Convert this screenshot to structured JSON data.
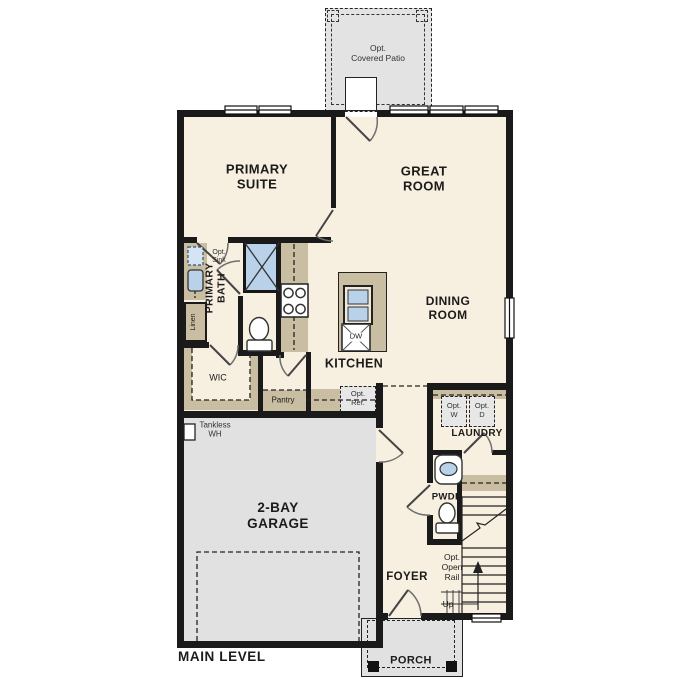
{
  "rooms": {
    "covered_patio": {
      "line1": "Opt.",
      "line2": "Covered Patio"
    },
    "primary_suite": {
      "line1": "PRIMARY",
      "line2": "SUITE"
    },
    "great_room": {
      "line1": "GREAT",
      "line2": "ROOM"
    },
    "primary_bath": {
      "line1": "PRIMARY",
      "line2": "BATH"
    },
    "wic": {
      "label": "WIC"
    },
    "linen": {
      "label": "Linen"
    },
    "kitchen": {
      "label": "KITCHEN"
    },
    "dining_room": {
      "line1": "DINING",
      "line2": "ROOM"
    },
    "pantry": {
      "label": "Pantry"
    },
    "garage": {
      "line1": "2-BAY",
      "line2": "GARAGE"
    },
    "laundry": {
      "label": "LAUNDRY"
    },
    "powder_room": {
      "label": "PWDR"
    },
    "foyer": {
      "label": "FOYER"
    },
    "porch": {
      "label": "PORCH"
    }
  },
  "fixtures": {
    "opt_sink": {
      "line1": "Opt.",
      "line2": "Sink"
    },
    "dishwasher": {
      "label": "DW"
    },
    "opt_ref": {
      "line1": "Opt.",
      "line2": "Ref."
    },
    "tankless_wh": {
      "line1": "Tankless",
      "line2": "WH"
    },
    "opt_washer": {
      "line1": "Opt.",
      "line2": "W"
    },
    "opt_dryer": {
      "line1": "Opt.",
      "line2": "D"
    }
  },
  "stairs": {
    "up": "Up",
    "opt_open_rail": {
      "line1": "Opt.",
      "line2": "Open",
      "line3": "Rail"
    }
  },
  "footer": {
    "level_label": "MAIN LEVEL"
  },
  "colors": {
    "wall": "#1a1a1a",
    "floor": "#f7efdf",
    "garage_floor": "#e1e1e1",
    "patio_floor": "#e3e3e3",
    "cabinet_tan": "#c9bda2",
    "fixture_blue": "#b9d1e9",
    "optional_gray": "#e7e7e7",
    "background": "#ffffff"
  }
}
